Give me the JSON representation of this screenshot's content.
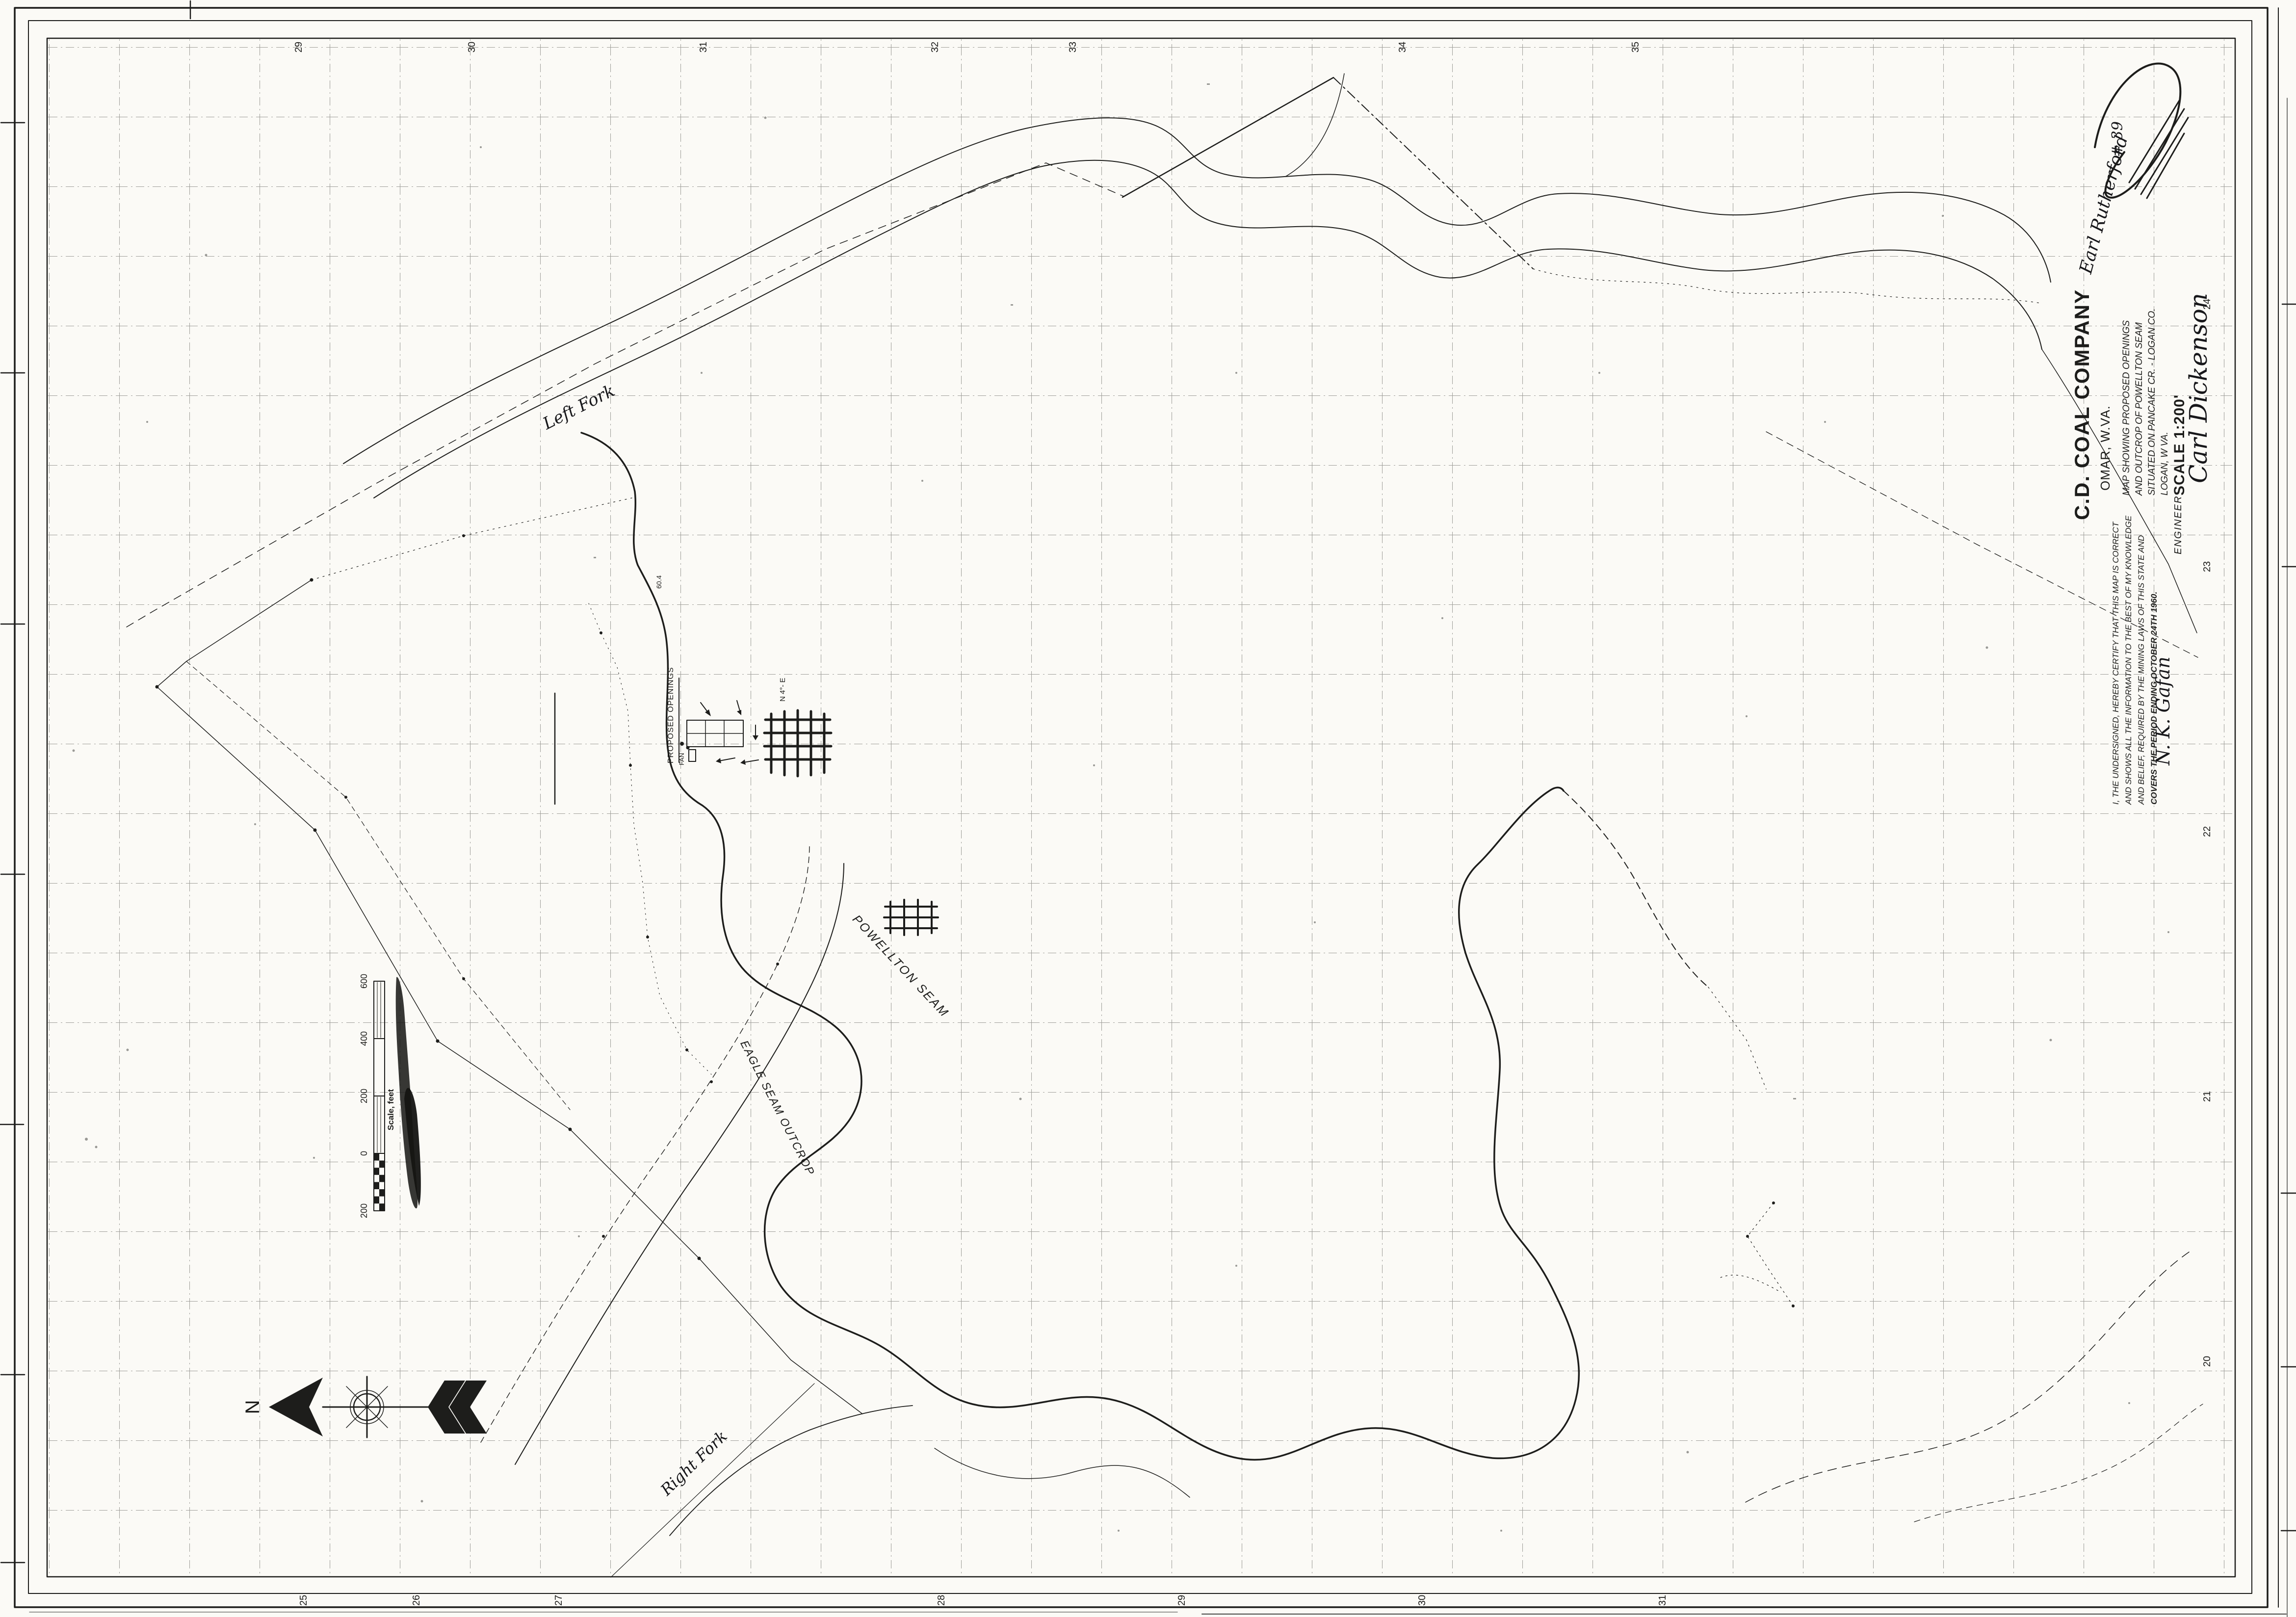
{
  "sheet": {
    "paper_color": "#fbfaf6",
    "ink_color": "#1d1d1b"
  },
  "title_block": {
    "company": "C.D. COAL COMPANY",
    "town": "OMAR, W.VA.",
    "desc_line1": "MAP SHOWING PROPOSED OPENINGS",
    "desc_line2": "AND OUTCROP OF POWELLTON SEAM",
    "desc_line3": "SITUATED ON PANCAKE CR. - LOGAN CO.",
    "desc_line4": "LOGAN, W VA.",
    "scale_label": "SCALE 1:200'",
    "scale_signature": "Carl Dickenson",
    "annotation_name": "Earl Rutherford",
    "annotation_number": "# 39"
  },
  "certification": {
    "line1": "I, THE UNDERSIGNED, HEREBY CERTIFY THAT THIS MAP IS CORRECT",
    "line2": "AND SHOWS ALL THE INFORMATION TO THE BEST OF MY KNOWLEDGE",
    "line3": "AND BELIEF, REQUIRED BY THE MINING LAWS OF THIS STATE AND",
    "line4": "COVERS THE PERIOD ENDING   OCTOBER 24TH 1960.",
    "signature": "N. K. Gafan",
    "title": "ENGINEER"
  },
  "map_labels": {
    "left_fork": "Left Fork",
    "right_fork": "Right Fork",
    "powellton_seam": "POWELLTON SEAM",
    "eagle_seam": "EAGLE SEAM OUTCROP",
    "proposed_openings": "PROPOSED OPENINGS",
    "fan": "FAN",
    "bearing": "N 4°- E",
    "spot_elevation": "60.4"
  },
  "scale_bar": {
    "labels": [
      "600",
      "400",
      "200",
      "0",
      "200"
    ],
    "caption": "Scale, feet"
  },
  "north_arrow": {
    "label": "N"
  },
  "grid_numbers": {
    "top": [
      "29",
      "30",
      "31",
      "32",
      "33",
      "34",
      "35"
    ],
    "bottom": [
      "25",
      "26",
      "27",
      "28",
      "29",
      "30",
      "31"
    ],
    "right": [
      "24",
      "23",
      "22",
      "21",
      "20"
    ]
  }
}
